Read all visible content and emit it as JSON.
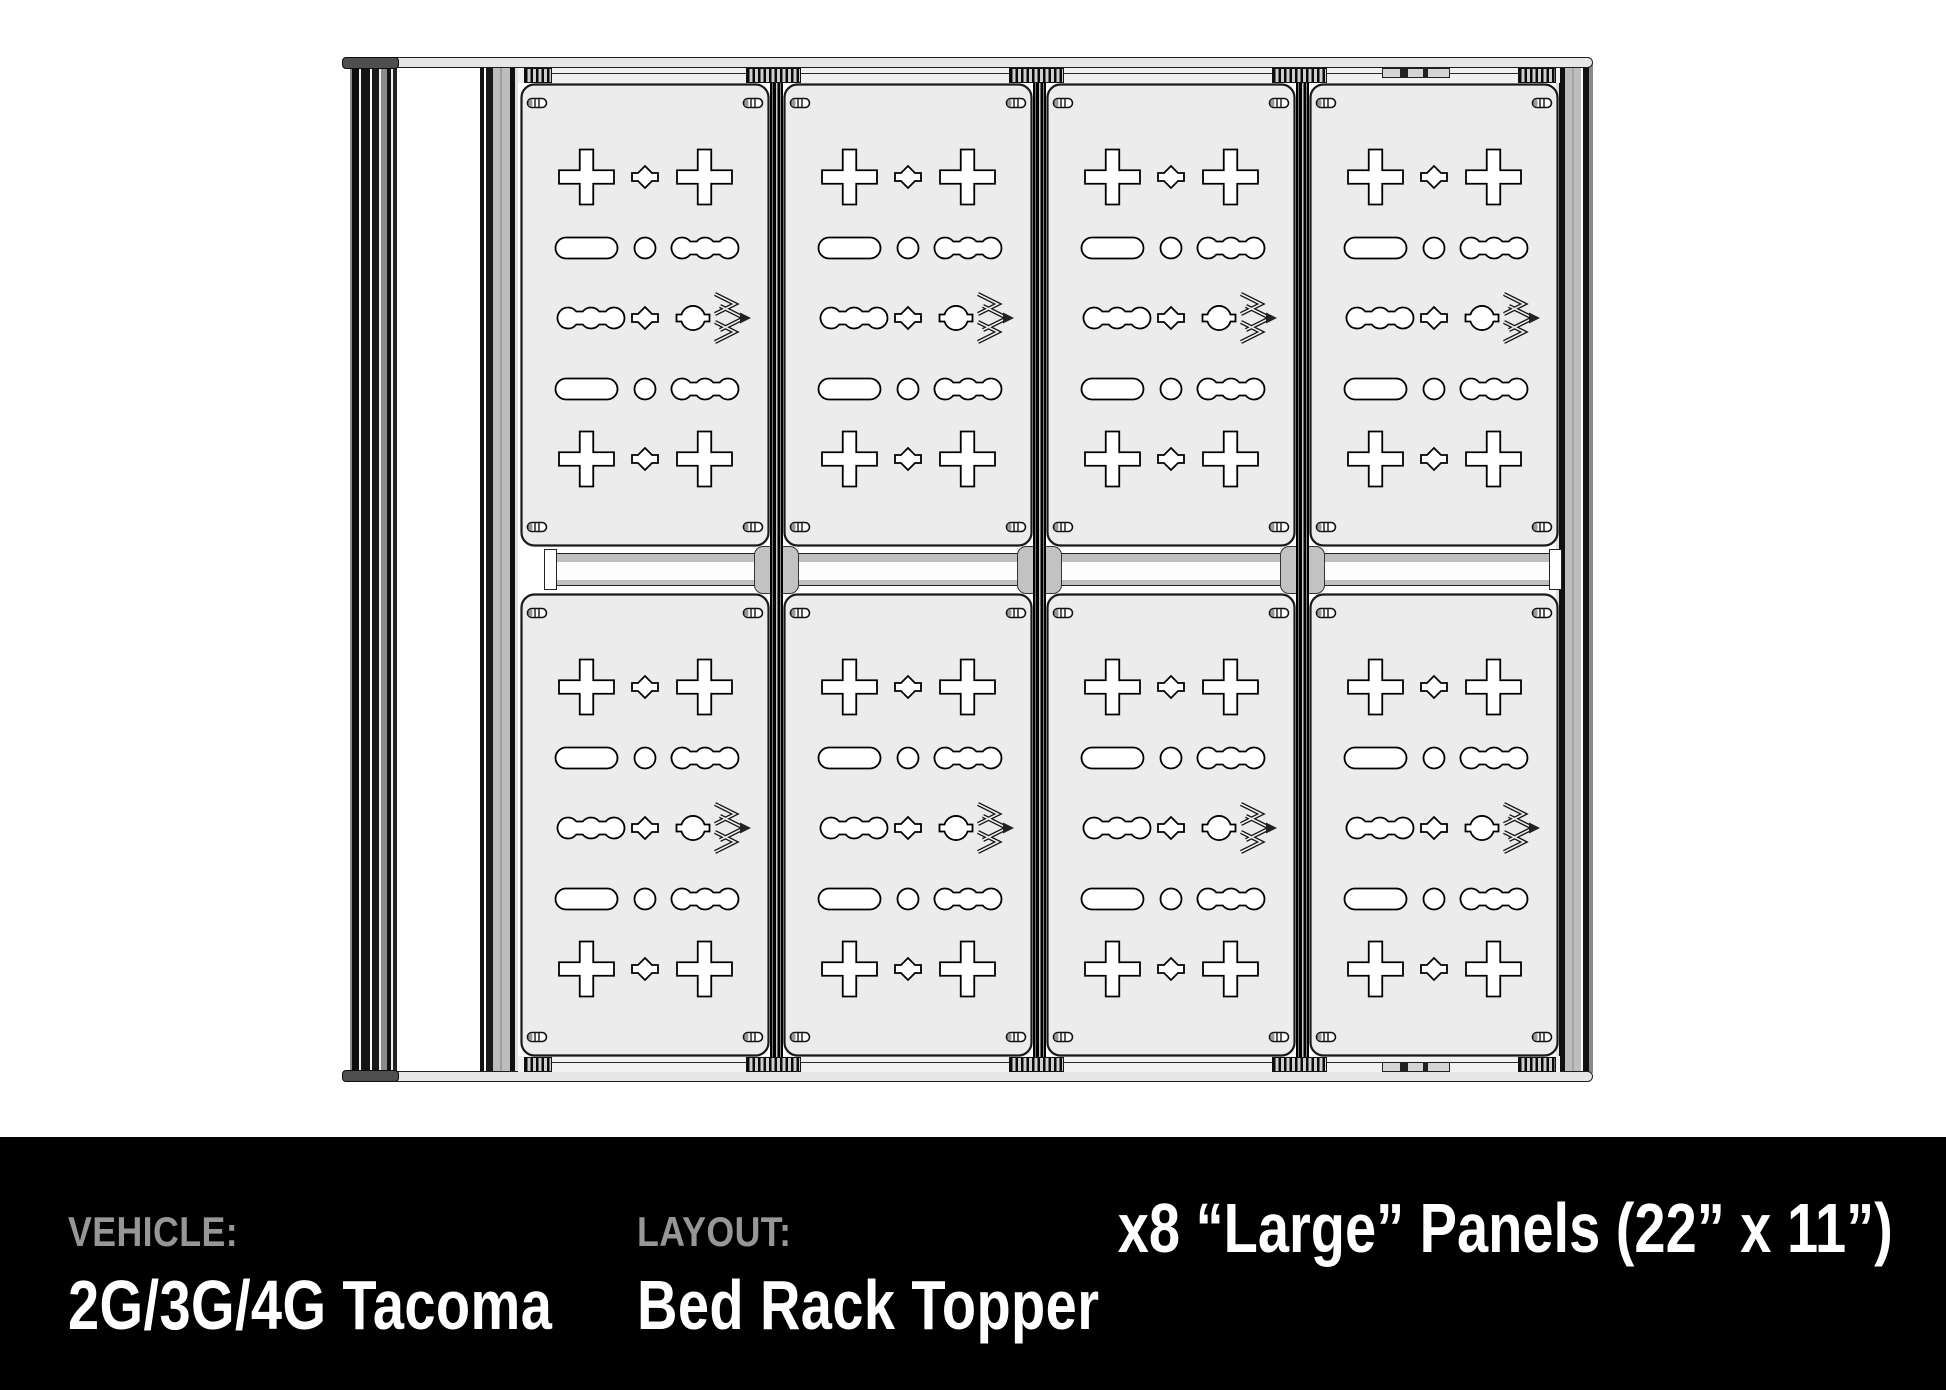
{
  "footer": {
    "vehicle_label": "VEHICLE:",
    "vehicle_value": "2G/3G/4G Tacoma",
    "layout_label": "LAYOUT:",
    "layout_value": "Bed Rack Topper",
    "panels_summary": "x8 “Large” Panels (22” x 11”)"
  },
  "drawing": {
    "description": "Top-down CAD drawing of a truck bed rack topper fitted with MOLLE accessory panels",
    "panel_count": 8,
    "panel_grid": {
      "columns": 4,
      "rows": 2
    },
    "panel_size_label": "22in x 11in Large panel",
    "cutout_rows_per_panel": 5
  },
  "colors": {
    "background": "#ffffff",
    "footer_bar": "#000000",
    "footer_label": "#969696",
    "footer_value": "#ffffff",
    "panel_fill": "#ececec",
    "rail_dark": "#141414",
    "rail_gray": "#bdbdbd",
    "crossbar_gray": "#bfbfbf"
  }
}
